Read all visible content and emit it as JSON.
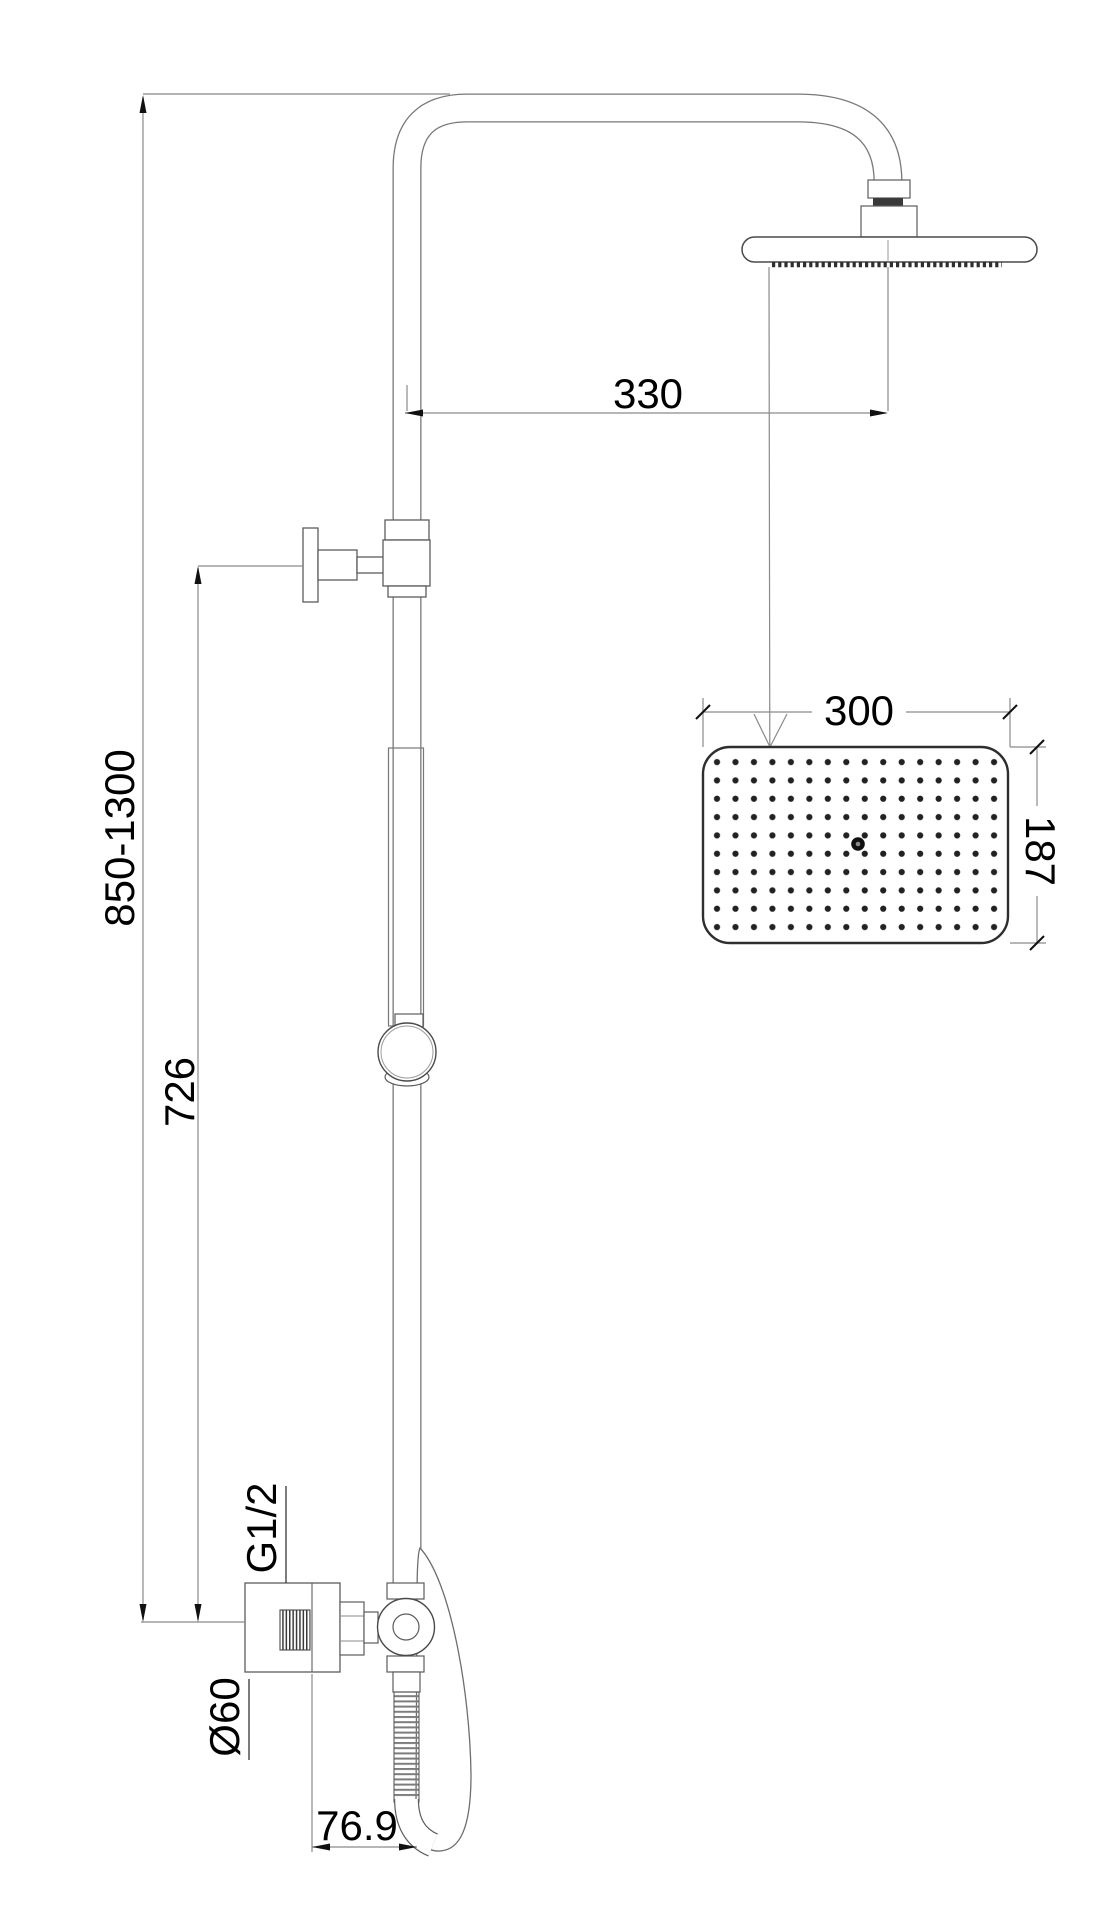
{
  "canvas": {
    "background": "#ffffff",
    "part_line_color": "#6e6e6e",
    "dimension_line_color": "#8a8a8a",
    "text_color": "#000000"
  },
  "dimensions": {
    "height_range": "850-1300",
    "bracket_drop": "726",
    "arm_offset": "330",
    "head_width": "300",
    "head_depth": "187",
    "inlet_thread": "G1/2",
    "plate_diameter": "Ø60",
    "outlet_offset": "76.9"
  }
}
